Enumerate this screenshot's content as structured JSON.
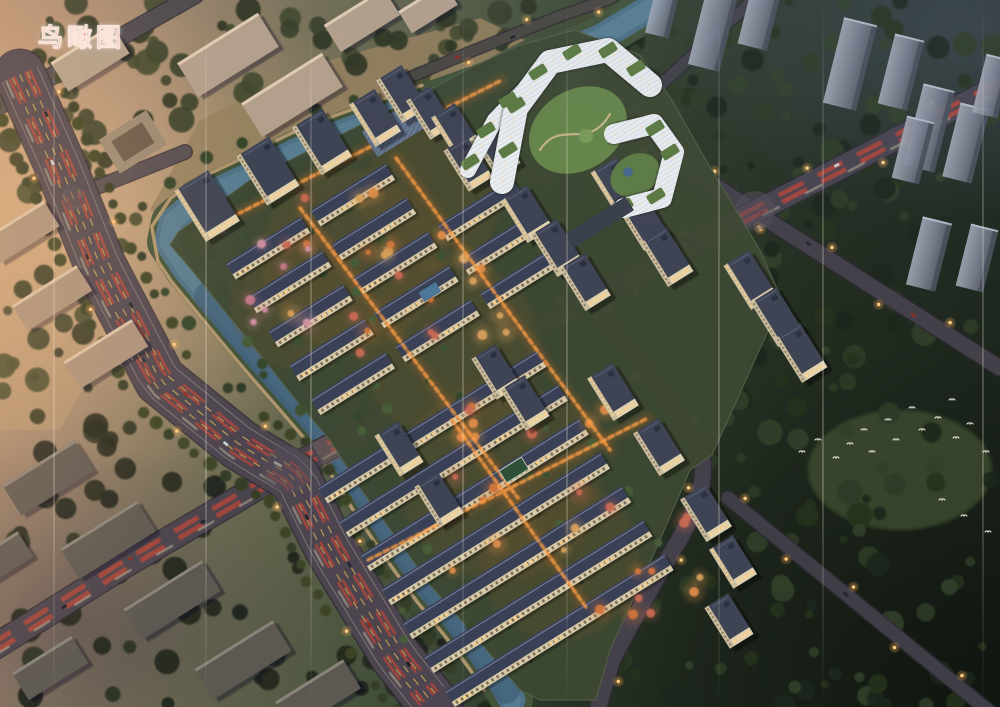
{
  "label": {
    "text": "鸟瞰图",
    "color": "#cf4737"
  },
  "palette": {
    "river": "#4e7186",
    "river_deep": "#3b5670",
    "river_bank": "#43543a",
    "walkway": "#b99b72",
    "asphalt": "#4c4550",
    "lane_yellow": "#cda852",
    "tail_light": "#cf4634",
    "head_light": "#e9ddb4",
    "tower_wall": "#ddd1b3",
    "tower_roof": "#3f4454",
    "row_roof": "#3a4156",
    "row_wall": "#d6c9a9",
    "window_lit": "#ffd084",
    "complex_white": "#e9edf0",
    "green_roof": "#5c7a42",
    "courtyard": "#66854a",
    "bg_tower_light": "#a2a8b4",
    "bg_tower_dark": "#565c68",
    "bird": "#e9e6dd",
    "street_lamp": "#ffca7e"
  },
  "scene": {
    "grid_angle": -32,
    "streak_xs": [
      53,
      205,
      310,
      462,
      566,
      718,
      822,
      982
    ],
    "ground": {
      "site_outline": "M 178,232 L 250,180 L 330,140 L 420,95 L 470,68 L 520,45 L 575,30 L 640,55 L 672,100 L 700,150 L 760,250 L 782,300 L 712,455 L 690,470 L 660,540 L 610,650 L 596,700 L 540,700 L 520,690 L 470,630 L 430,585 L 398,540 L 360,488 L 330,440 L 300,405 L 258,352 L 222,308 L 190,268 L 170,245 Z",
      "site_fill": "#3d4832",
      "tan_northwest": "M 150,210 L 200,120 L 330,60 L 480,18 L 525,40 L 350,130 L 250,180 L 175,225 Z",
      "tan_fill": "#97815f",
      "warm_west_patch": "M 0,60 L 30,60 L 120,320 L 60,430 L 0,430 Z",
      "clearing": [
        900,
        470,
        92,
        60
      ],
      "glow_spots": [
        [
          350,
          260,
          90
        ],
        [
          450,
          350,
          90
        ],
        [
          500,
          480,
          100
        ],
        [
          560,
          560,
          80
        ],
        [
          300,
          300,
          70
        ],
        [
          430,
          200,
          70
        ]
      ]
    },
    "river": {
      "main": "M 655,5 L 600,38 L 540,62 L 480,85 L 415,108 L 350,130 L 295,152 L 245,178 L 198,200 L 172,222 L 168,242 L 185,268 L 208,296 L 232,325 L 258,356 L 286,388 L 312,418 L 332,442 L 350,468 L 368,498 L 388,528 L 410,560 L 432,590 L 455,618 L 478,648 L 498,676 L 512,700",
      "width": 27,
      "bank_width": 42,
      "deep_from": 0.55
    },
    "roads": [
      {
        "name": "branch-road-northwest",
        "d": "M -8,242 L 70,198 L 185,152",
        "w": 13,
        "color": "#564e52"
      },
      {
        "name": "corner-road-northwest",
        "d": "M -8,110 L 195,-5",
        "w": 16,
        "color": "#4f4a4e",
        "cars": [
          [
            0.35,
            0,
            "#1c2026"
          ],
          [
            0.6,
            3,
            "#23282e"
          ]
        ]
      },
      {
        "name": "riverside-road-north",
        "d": "M 392,85 L 470,52 L 560,16 L 612,-2",
        "w": 10,
        "color": "#4a4742",
        "lights": true,
        "cars": [
          [
            0.3,
            0,
            "#8a2e26"
          ],
          [
            0.55,
            2,
            "#22262c"
          ]
        ]
      },
      {
        "name": "northeast-road",
        "d": "M 595,145 L 762,-8",
        "w": 11,
        "color": "#414047"
      },
      {
        "name": "east-road-diagonal",
        "d": "M 575,92 L 755,212 L 1000,368",
        "w": 15,
        "color": "#434049",
        "lights": true,
        "cars": [
          [
            0.25,
            2,
            "#1d2127"
          ],
          [
            0.55,
            -2,
            "#23282e"
          ],
          [
            0.8,
            2,
            "#8a2e26"
          ]
        ]
      },
      {
        "name": "southeast-boundary-road",
        "d": "M 588,300 Q 665,390 700,450 Q 712,486 676,545 Q 648,592 612,660 L 598,708",
        "w": 16,
        "color": "#44414b",
        "lights": true
      },
      {
        "name": "forest-road-southeast",
        "d": "M 728,498 L 990,712",
        "w": 13,
        "color": "#3f3d46",
        "lights": true,
        "cars": [
          [
            0.45,
            0,
            "#23272e"
          ]
        ]
      },
      {
        "name": "east-road-main",
        "d": "M 548,322 L 755,212 L 1010,80",
        "w": 22,
        "color": "#46434e",
        "streaks": true,
        "lights": true,
        "cars": [
          [
            0.12,
            4,
            "#1d2127"
          ],
          [
            0.28,
            -4,
            "#23282e"
          ],
          [
            0.46,
            4,
            "#8a2e26"
          ],
          [
            0.63,
            -4,
            "#c8ccd1"
          ],
          [
            0.82,
            3,
            "#1d2127"
          ]
        ]
      },
      {
        "name": "cross-road-southwest",
        "d": "M -10,650 L 120,568 L 287,470 L 402,408",
        "w": 24,
        "color": "#4a444e",
        "streaks": true,
        "cars": [
          [
            0.18,
            3,
            "#1d2127"
          ],
          [
            0.35,
            -3,
            "#8a2e26"
          ],
          [
            0.52,
            2,
            "#23282e"
          ],
          [
            0.72,
            -2,
            "#c8ccd1"
          ]
        ]
      },
      {
        "name": "main-avenue-west",
        "d": "M 20,75 L 60,165 L 100,265 L 160,380 L 240,445 L 295,478 L 330,548 L 395,655 L 438,710",
        "w": 50,
        "color": "#4c4550",
        "lanes": true,
        "streaks": true,
        "trees": true,
        "lights": true,
        "cars": [
          [
            0.06,
            -8,
            "#1d2127"
          ],
          [
            0.12,
            6,
            "#c8ccd1"
          ],
          [
            0.18,
            -6,
            "#8a2e26"
          ],
          [
            0.25,
            9,
            "#22262e"
          ],
          [
            0.33,
            -9,
            "#1d2127"
          ],
          [
            0.4,
            5,
            "#2a3340"
          ],
          [
            0.47,
            -5,
            "#8a2e26"
          ],
          [
            0.55,
            8,
            "#c8ccd1"
          ],
          [
            0.62,
            -3,
            "#dad6ca",
            9
          ],
          [
            0.7,
            7,
            "#1d2127"
          ],
          [
            0.78,
            -8,
            "#22262e"
          ],
          [
            0.86,
            6,
            "#8a2e26"
          ],
          [
            0.93,
            -5,
            "#1d2127"
          ]
        ]
      }
    ],
    "junctions": [
      [
        287,
        470,
        24
      ],
      [
        755,
        211,
        20
      ],
      [
        73,
        199,
        12
      ]
    ],
    "bridge": {
      "d": "M 318,455 L 362,431",
      "w": 27
    },
    "forest_regions": [
      {
        "x": 600,
        "y": 0,
        "w": 400,
        "h": 330,
        "n": 95,
        "p": "ne",
        "s": 11
      },
      {
        "x": 700,
        "y": 300,
        "w": 300,
        "h": 270,
        "n": 60,
        "p": "ne",
        "s": 12
      },
      {
        "x": 560,
        "y": 560,
        "w": 440,
        "h": 150,
        "n": 48,
        "p": "ne",
        "s": 13
      },
      {
        "x": 300,
        "y": 615,
        "w": 240,
        "h": 95,
        "n": 18,
        "p": "sw",
        "s": 14
      },
      {
        "x": 0,
        "y": 425,
        "w": 310,
        "h": 285,
        "n": 42,
        "p": "sw",
        "s": 15
      },
      {
        "x": 0,
        "y": 0,
        "w": 460,
        "h": 125,
        "n": 60,
        "p": "nw",
        "s": 16
      },
      {
        "x": 0,
        "y": 120,
        "w": 150,
        "h": 320,
        "n": 34,
        "p": "nw",
        "s": 17
      },
      {
        "x": 430,
        "y": 0,
        "w": 190,
        "h": 60,
        "n": 16,
        "p": "nw",
        "s": 18
      },
      {
        "x": 620,
        "y": 40,
        "w": 120,
        "h": 140,
        "n": 22,
        "p": "ne",
        "s": 19
      }
    ],
    "site_tree_regions": [
      {
        "x": 230,
        "y": 230,
        "w": 330,
        "h": 200,
        "n": 26,
        "s": 21
      },
      {
        "x": 360,
        "y": 420,
        "w": 300,
        "h": 230,
        "n": 26,
        "s": 22
      }
    ],
    "autumn_regions": [
      {
        "x": 280,
        "y": 185,
        "w": 230,
        "h": 180,
        "n": 24,
        "s": 31
      },
      {
        "x": 400,
        "y": 385,
        "w": 250,
        "h": 200,
        "n": 18,
        "s": 32
      },
      {
        "x": 545,
        "y": 480,
        "w": 170,
        "h": 160,
        "n": 10,
        "s": 33
      },
      {
        "x": 195,
        "y": 215,
        "w": 115,
        "h": 115,
        "n": 8,
        "s": 34,
        "pink": true
      }
    ],
    "paths_lit": [
      "M 222,222 L 502,80",
      "M 300,208 L 518,498",
      "M 396,158 L 610,450",
      "M 368,560 L 648,418",
      "M 452,420 L 588,610"
    ],
    "row_grids": [
      {
        "origin": [
          268,
          248
        ],
        "cols": 3,
        "rows": 5,
        "du": 100,
        "dv": 40,
        "skip": [
          "2,0",
          "2,1"
        ]
      },
      {
        "origin": [
          360,
          472
        ],
        "cols": 3,
        "rows": 7,
        "du": 85,
        "dv": 40,
        "skip": []
      }
    ],
    "row_size": [
      88,
      19
    ],
    "towers": [
      [
        207,
        206,
        40,
        60
      ],
      [
        268,
        171,
        38,
        58
      ],
      [
        322,
        142,
        36,
        56
      ],
      [
        375,
        118,
        30,
        50
      ],
      [
        402,
        94,
        30,
        50
      ],
      [
        430,
        113,
        28,
        46
      ],
      [
        455,
        130,
        28,
        46
      ],
      [
        468,
        164,
        28,
        48
      ],
      [
        496,
        150,
        28,
        48
      ],
      [
        527,
        214,
        30,
        50
      ],
      [
        557,
        248,
        30,
        50
      ],
      [
        585,
        282,
        30,
        50
      ],
      [
        617,
        187,
        30,
        52
      ],
      [
        643,
        221,
        30,
        52
      ],
      [
        667,
        257,
        30,
        52
      ],
      [
        750,
        280,
        30,
        52
      ],
      [
        777,
        317,
        30,
        52
      ],
      [
        801,
        353,
        30,
        52
      ],
      [
        613,
        392,
        30,
        50
      ],
      [
        659,
        447,
        30,
        50
      ],
      [
        706,
        513,
        30,
        50
      ],
      [
        733,
        562,
        28,
        46
      ],
      [
        496,
        372,
        28,
        48
      ],
      [
        525,
        403,
        28,
        48
      ],
      [
        399,
        449,
        28,
        48
      ],
      [
        439,
        500,
        28,
        48
      ],
      [
        729,
        621,
        28,
        48
      ]
    ],
    "complex": {
      "bands": [
        {
          "d": "M 468,170 L 495,120 L 522,92",
          "w": 16
        },
        {
          "d": "M 502,182 L 516,108 L 550,62 L 608,50 L 650,85",
          "w": 24
        },
        {
          "d": "M 614,134 L 654,124 L 674,152 L 662,198 L 624,208",
          "w": 20
        }
      ],
      "green_patches": [
        [
          470,
          162
        ],
        [
          486,
          130
        ],
        [
          508,
          100
        ],
        [
          508,
          150
        ],
        [
          516,
          105
        ],
        [
          538,
          72
        ],
        [
          572,
          52
        ],
        [
          608,
          50
        ],
        [
          636,
          68
        ],
        [
          655,
          128
        ],
        [
          670,
          152
        ],
        [
          656,
          196
        ],
        [
          624,
          206
        ]
      ],
      "courtyard": [
        578,
        130,
        52,
        40
      ],
      "garden_se": [
        635,
        175,
        26,
        20
      ],
      "pond": [
        628,
        172,
        5
      ],
      "path": "M 540,150 C 560,118 588,152 610,114",
      "service_strip": [
        600,
        222,
        70,
        16
      ]
    },
    "amenities": {
      "court": [
        514,
        470,
        26,
        14
      ],
      "pool": [
        430,
        292,
        20,
        11
      ],
      "canopy": [
        396,
        128,
        62,
        30
      ],
      "courtyard_building": [
        133,
        142,
        56,
        40
      ]
    },
    "bg_nw_slabs": [
      [
        90,
        58,
        72,
        34
      ],
      [
        228,
        55,
        95,
        40
      ],
      [
        292,
        95,
        95,
        40
      ],
      [
        362,
        20,
        70,
        32
      ],
      [
        428,
        8,
        54,
        26
      ]
    ],
    "bg_w_slabs": [
      [
        22,
        232,
        70,
        30
      ],
      [
        52,
        298,
        76,
        30
      ],
      [
        106,
        354,
        80,
        32
      ]
    ],
    "bg_sw_slabs": [
      [
        48,
        478,
        85,
        36
      ],
      [
        108,
        540,
        90,
        36
      ],
      [
        172,
        600,
        92,
        36
      ],
      [
        243,
        660,
        92,
        36
      ],
      [
        318,
        695,
        80,
        34
      ],
      [
        50,
        668,
        70,
        32
      ],
      [
        0,
        560,
        60,
        30
      ]
    ],
    "bg_ne_towers": [
      [
        713,
        30,
        32,
        78
      ],
      [
        760,
        16,
        30,
        64
      ],
      [
        850,
        64,
        34,
        88
      ],
      [
        901,
        72,
        30,
        72
      ],
      [
        929,
        128,
        32,
        84
      ],
      [
        966,
        143,
        30,
        76
      ],
      [
        992,
        86,
        26,
        60
      ],
      [
        662,
        14,
        24,
        44
      ],
      [
        575,
        95,
        28,
        58
      ],
      [
        913,
        150,
        28,
        64
      ],
      [
        929,
        254,
        30,
        70
      ],
      [
        977,
        258,
        28,
        64
      ]
    ],
    "birds": [
      [
        802,
        452
      ],
      [
        818,
        440
      ],
      [
        836,
        458
      ],
      [
        850,
        444
      ],
      [
        864,
        430
      ],
      [
        872,
        452
      ],
      [
        888,
        420
      ],
      [
        896,
        440
      ],
      [
        912,
        408
      ],
      [
        922,
        430
      ],
      [
        938,
        418
      ],
      [
        952,
        400
      ],
      [
        956,
        438
      ],
      [
        970,
        424
      ],
      [
        986,
        452
      ],
      [
        942,
        500
      ],
      [
        964,
        516
      ],
      [
        988,
        532
      ]
    ]
  }
}
